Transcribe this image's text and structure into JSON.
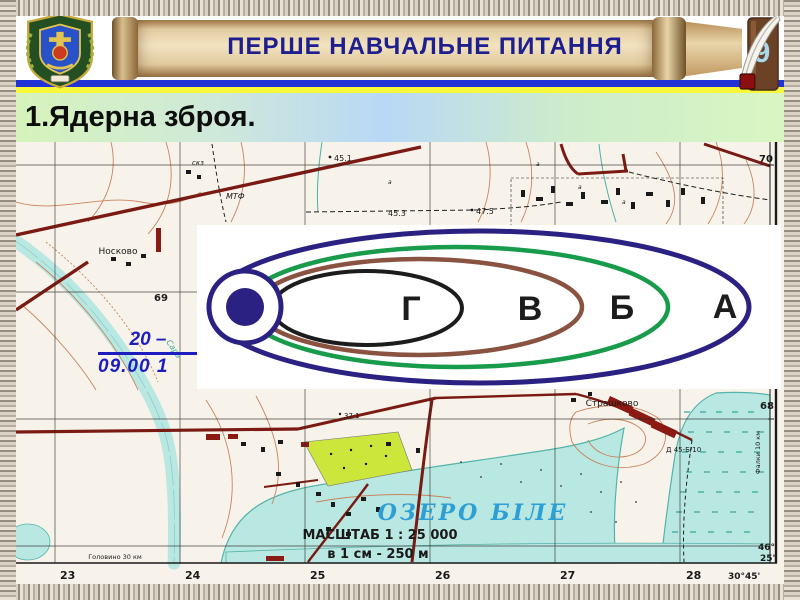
{
  "header": {
    "banner_title": "ПЕРШЕ НАВЧАЛЬНЕ ПИТАННЯ",
    "slide_number": "9"
  },
  "title_bar": {
    "text": "1.Ядерна зброя."
  },
  "map_annotation": {
    "line1": "20 –",
    "line2": "09.00 1",
    "color": "#1d1dbf"
  },
  "diagram": {
    "zones": [
      {
        "label": "А",
        "color": "#2b2182"
      },
      {
        "label": "Б",
        "color": "#189b4a"
      },
      {
        "label": "В",
        "color": "#8a5240"
      },
      {
        "label": "Г",
        "color": "#1c1c1c"
      }
    ],
    "epicenter_color": "#2b2182"
  },
  "map": {
    "settlements": {
      "noskovo": "Носково",
      "strashkovo": "Страшково"
    },
    "labels": {
      "mtf": "МТФ",
      "skz": "скз",
      "unit": "Д 45-Б/10",
      "river": "Сара",
      "veg": "а"
    },
    "lake_name": "ОЗЕРО  БІЛЕ",
    "scale_line1": "МАСШТАБ  1 : 25 000",
    "scale_line2": "в 1 см - 250 м",
    "elevations": {
      "e1": "45.1",
      "e2": "45.3",
      "e3": "47.5",
      "e4": "37.1"
    },
    "grid_x": [
      "23",
      "24",
      "25",
      "26",
      "27",
      "28"
    ],
    "grid_y": {
      "top": "70",
      "mid": "69",
      "bottom": "68"
    },
    "corner": {
      "lon": "30°45'",
      "lat_deg": "46°",
      "lat_min": "25'"
    },
    "road_signs": {
      "left_bottom": "Головино 30 км",
      "right": "Фалки 10 км"
    }
  }
}
